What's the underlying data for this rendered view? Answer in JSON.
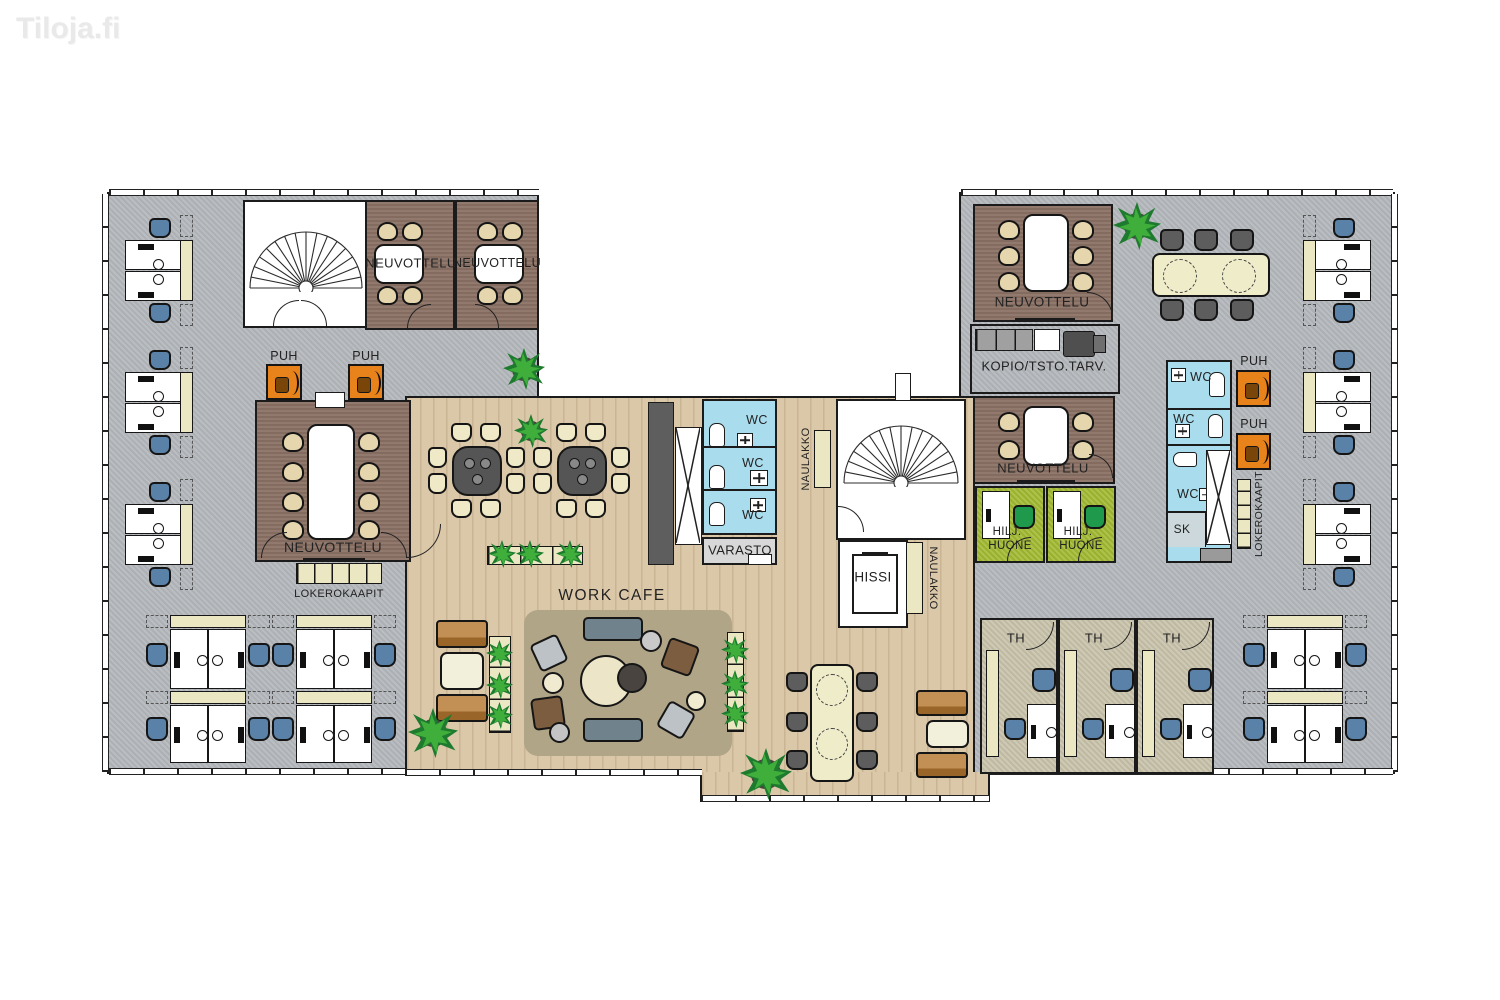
{
  "watermark": "Tiloja.fi",
  "plan": {
    "rooms": {
      "meeting": "NEUVOTTELU",
      "phone_booth": "PUH",
      "toilet": "WC",
      "storage": "VARASTO",
      "elevator": "HISSI",
      "coat_rack": "NAULAKKO",
      "work_cafe": "WORK CAFE",
      "lockers": "LOKEROKAAPIT",
      "copy_office_supplies": "KOPIO/TSTO.TARV.",
      "quiet_room_line1": "HILJ.",
      "quiet_room_line2": "HUONE",
      "small_office": "TH",
      "cleaning_closet": "SK"
    },
    "colors": {
      "carpet": "#b6b9bd",
      "wood_floor": "#dbc8a9",
      "meeting_room_floor": "#8c7266",
      "wc_floor": "#a9dcec",
      "quiet_room_floor": "#a2b931",
      "small_office_floor": "#c9c3ab",
      "storage_floor": "#d8d8d8",
      "rug": "#b1a588",
      "phone_booth": "#e8831c",
      "locker": "#ece7c3",
      "desk_chair": "#5a82a8",
      "meeting_chair": "#e5d6ad",
      "quiet_chair": "#1f9a4d",
      "wall": "#1b1b1b",
      "watermark_color": "#e9e9e9"
    }
  }
}
